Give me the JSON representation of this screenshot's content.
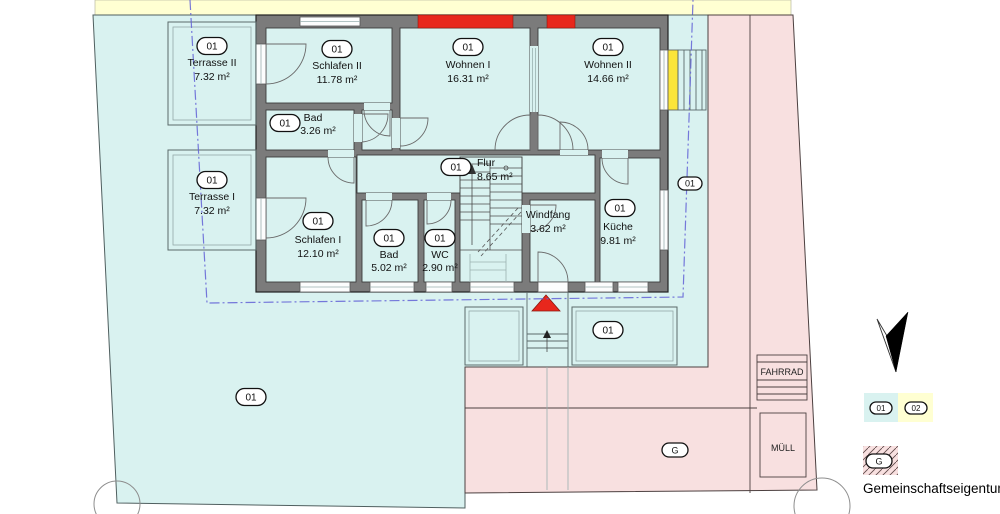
{
  "plan": {
    "rooms": {
      "terrasse2": {
        "badge": "01",
        "name": "Terrasse II",
        "area": "7.32 m²"
      },
      "schlafen2": {
        "badge": "01",
        "name": "Schlafen II",
        "area": "11.78 m²"
      },
      "wohnen1": {
        "badge": "01",
        "name": "Wohnen I",
        "area": "16.31 m²"
      },
      "wohnen2": {
        "badge": "01",
        "name": "Wohnen II",
        "area": "14.66 m²"
      },
      "bad2": {
        "badge": "01",
        "name": "Bad",
        "area": "3.26 m²"
      },
      "flur": {
        "badge": "01",
        "name": "Flur",
        "area": "8.65 m²"
      },
      "terrasse1": {
        "badge": "01",
        "name": "Terrasse I",
        "area": "7.32 m²"
      },
      "schlafen1": {
        "badge": "01",
        "name": "Schlafen I",
        "area": "12.10 m²"
      },
      "bad1": {
        "badge": "01",
        "name": "Bad",
        "area": "5.02 m²"
      },
      "wc": {
        "badge": "01",
        "name": "WC",
        "area": "2.90 m²"
      },
      "windfang": {
        "name": "Windfang",
        "area": "3.62 m²"
      },
      "kueche": {
        "badge": "01",
        "name": "Küche",
        "area": "9.81 m²"
      }
    },
    "site": {
      "garden_badge": "01",
      "entry_terrace_badge": "01",
      "east_strip_badge": "01",
      "communal_badge": "G",
      "bike_label": "FAHRRAD",
      "waste_label": "MÜLL"
    }
  },
  "legend": {
    "unit1_badge": "01",
    "unit2_badge": "02",
    "communal_badge": "G",
    "communal_text": "Gemeinschaftseigentum"
  },
  "colors": {
    "unit1_cyan": "#d9f2f0",
    "unit2_yellow": "#ffffd2",
    "communal_pink": "#f8e0e0",
    "highlight_red": "#e8271c",
    "access_yellow": "#fbe539",
    "wall_gray": "#7b7b7b",
    "boundary_blue": "#6161d6"
  }
}
